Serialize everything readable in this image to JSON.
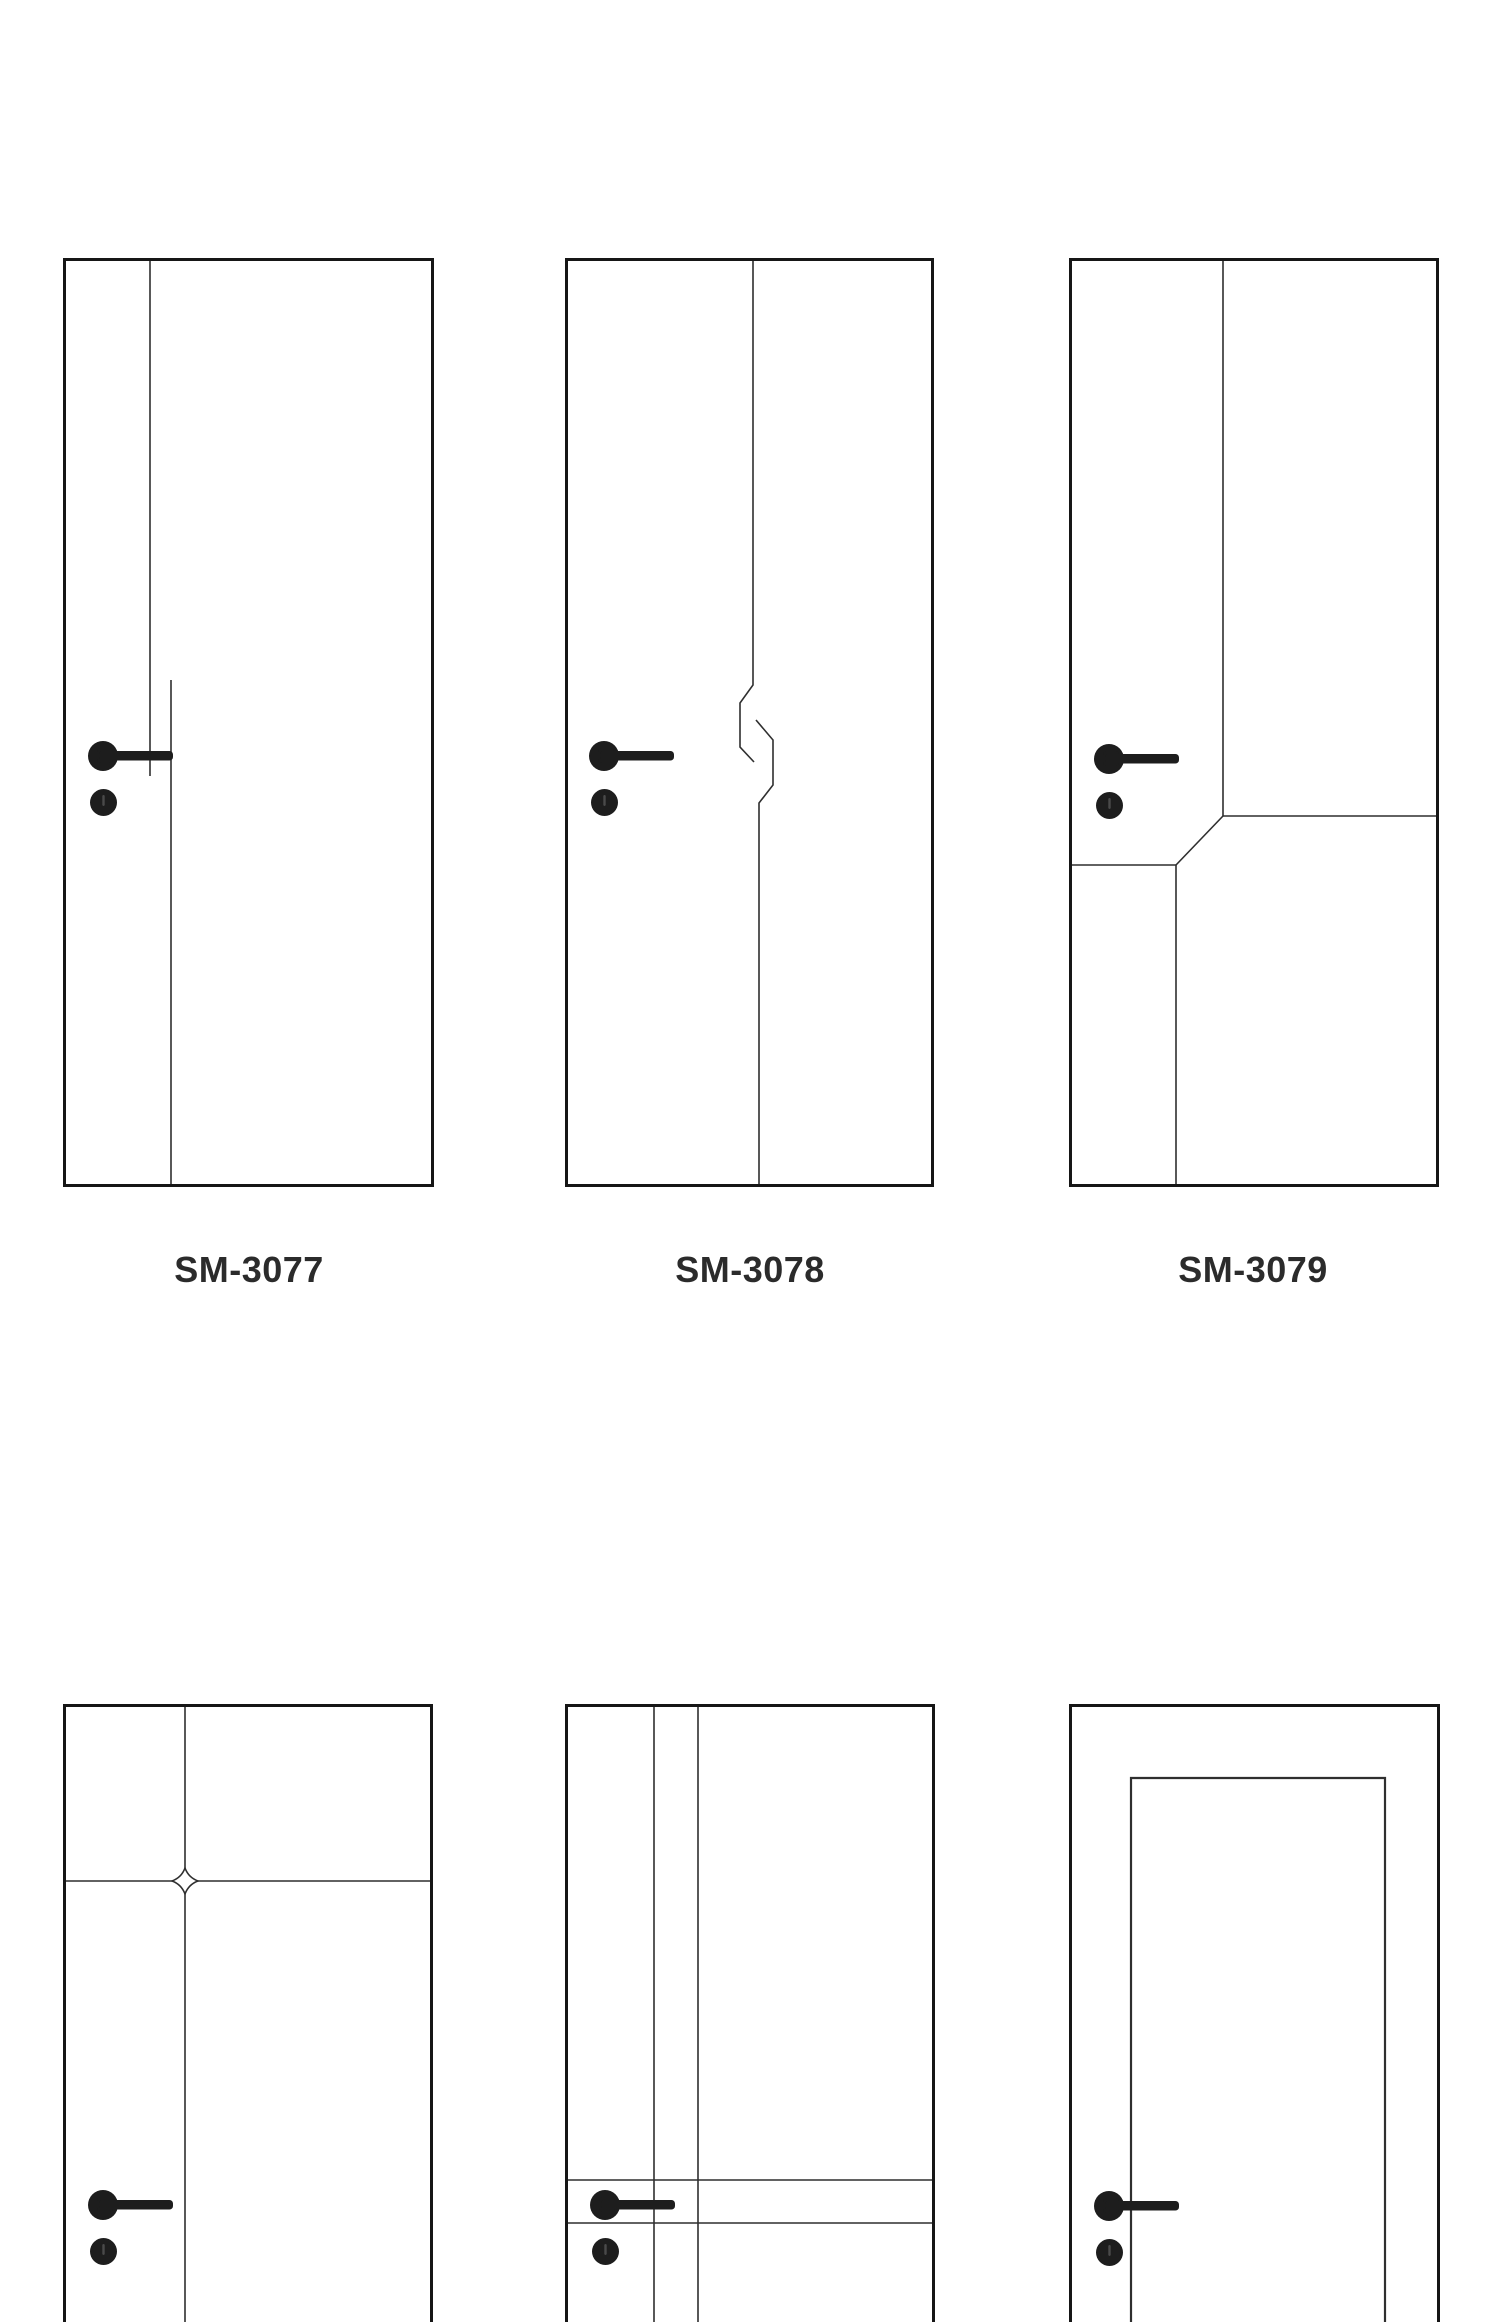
{
  "page": {
    "kind": "door design catalog sheet",
    "background": "#ffffff"
  },
  "colors": {
    "outline": "#161616",
    "groove": "#2f2f2f",
    "hardware": "#1d1d1d",
    "label": "#2b2b2b"
  },
  "catalog": {
    "doors": [
      {
        "model": "SM-3077"
      },
      {
        "model": "SM-3078"
      },
      {
        "model": "SM-3079"
      },
      {
        "model": ""
      },
      {
        "model": ""
      },
      {
        "model": ""
      }
    ]
  }
}
